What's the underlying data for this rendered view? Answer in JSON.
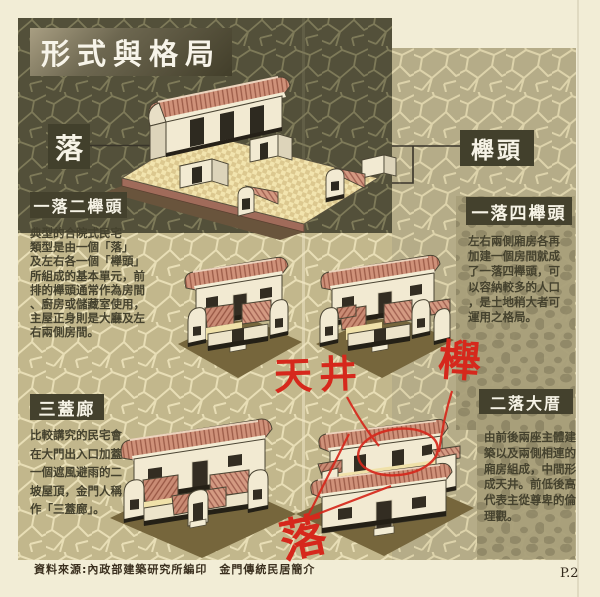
{
  "page": {
    "title": "形式與格局",
    "footer_source": "資料來源:內政部建築研究所編印　金門傳統民居簡介",
    "page_number": "P.2"
  },
  "diagram_labels": {
    "luo": "落",
    "ju_tou": "櫸頭"
  },
  "sections": [
    {
      "id": "yi-luo-er-ju-tou",
      "title": "一落二櫸頭",
      "lines": [
        "典型的合院式民宅",
        "類型是由一個「落」",
        "及左右各一個「櫸頭」",
        "所組成的基本單元，前",
        "排的櫸頭通常作為房間",
        "、廚房或儲藏室使用，",
        "主屋正身則是大廳及左",
        "右兩側房間。"
      ]
    },
    {
      "id": "yi-luo-si-ju-tou",
      "title": "一落四櫸頭",
      "lines": [
        "左右兩側廂房各再",
        "加建一個房間就成",
        "了一落四櫸頭，可",
        "以容納較多的人口",
        "，是土地稍大者可",
        "運用之格局。"
      ]
    },
    {
      "id": "san-gai-lang",
      "title": "三蓋廊",
      "lines": [
        "比較講究的民宅會",
        "在大門出入口加蓋",
        "一個遮風避雨的二",
        "坡屋頂，金門人稱",
        "作「三蓋廊」。"
      ]
    },
    {
      "id": "er-luo-da-cuo",
      "title": "二落大厝",
      "lines": [
        "由前後兩座主體建",
        "築以及兩側相連的",
        "廂房組成，中間形",
        "成天井。前低後高",
        "代表主從尊卑的倫",
        "理觀。"
      ]
    }
  ],
  "annotations": {
    "tian_jing": "天井",
    "ju": "櫸",
    "luo": "落"
  },
  "colors": {
    "page_bg": "#f2edd6",
    "dark_texture": "#53503a",
    "light_texture": "#c2b78c",
    "label_bg": "#42402c",
    "roof_tile": "#cf9179",
    "annotation_red": "#d6281c"
  }
}
